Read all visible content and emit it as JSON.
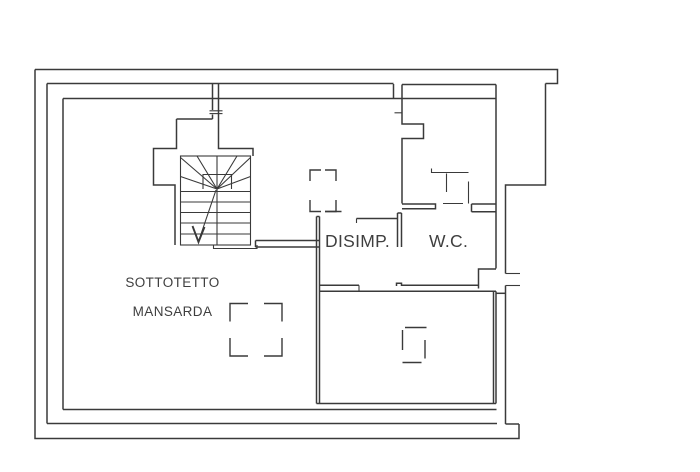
{
  "title": "Attic floor plan drawing",
  "colors": {
    "background": "#ffffff",
    "wall": "#3a3a3a",
    "text": "#3f3f3f"
  },
  "rooms": {
    "sottotetto": {
      "line1": "SOTTOTETTO",
      "line2": "MANSARDA"
    },
    "disimpegno": {
      "label": "DISIMP."
    },
    "wc": {
      "label": "W.C."
    }
  }
}
